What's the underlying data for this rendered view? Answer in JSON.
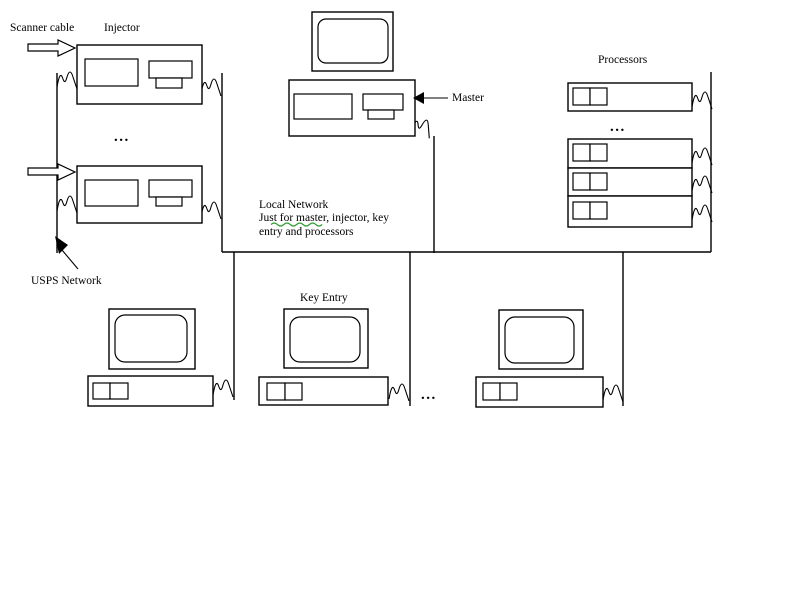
{
  "colors": {
    "ink": "#000000",
    "background": "#ffffff",
    "grammar_check": "#2f9e2f"
  },
  "labels": {
    "scanner_cable": "Scanner cable",
    "injector": "Injector",
    "master": "Master",
    "processors": "Processors",
    "usps_network": "USPS Network",
    "key_entry": "Key Entry",
    "ellipsis": "..."
  },
  "annotation": {
    "line1": "Local Network",
    "line2": "Just for master, injector, key",
    "line3": "entry and processors"
  },
  "counts": {
    "injectors_shown": 2,
    "processor_units_shown": 4,
    "key_entry_workstations_shown": 3,
    "master_computers_shown": 1
  }
}
